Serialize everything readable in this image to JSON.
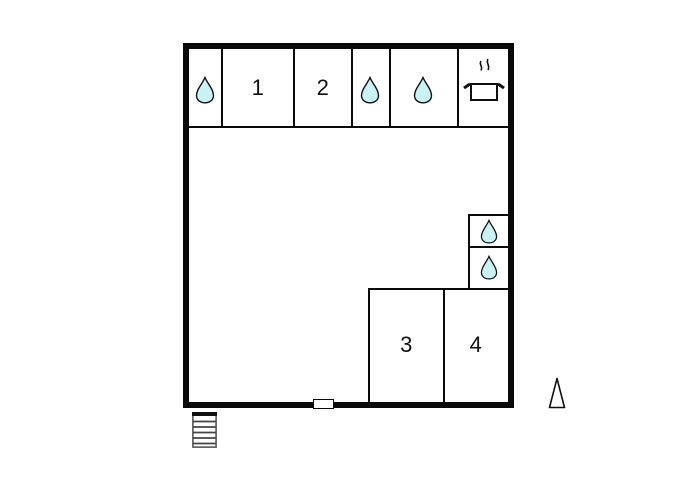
{
  "plan": {
    "type": "floor-plan",
    "rooms": [
      {
        "label": "1"
      },
      {
        "label": "2"
      },
      {
        "label": "3"
      },
      {
        "label": "4"
      }
    ],
    "icons": {
      "water_drop": "teardrop (water/bathroom) icon, appears 5 times",
      "kitchen_pot": "cooking pot with steam (kitchen) icon",
      "stairs": "stairs icon outside bottom-left of plan",
      "north_arrow": "narrow outlined triangle pointing up, bottom-right",
      "door": "door opening marker on bottom wall"
    },
    "colors": {
      "wall": "#0a0a0a",
      "drop_fill": "#c9f2f5",
      "background": "#ffffff"
    }
  }
}
